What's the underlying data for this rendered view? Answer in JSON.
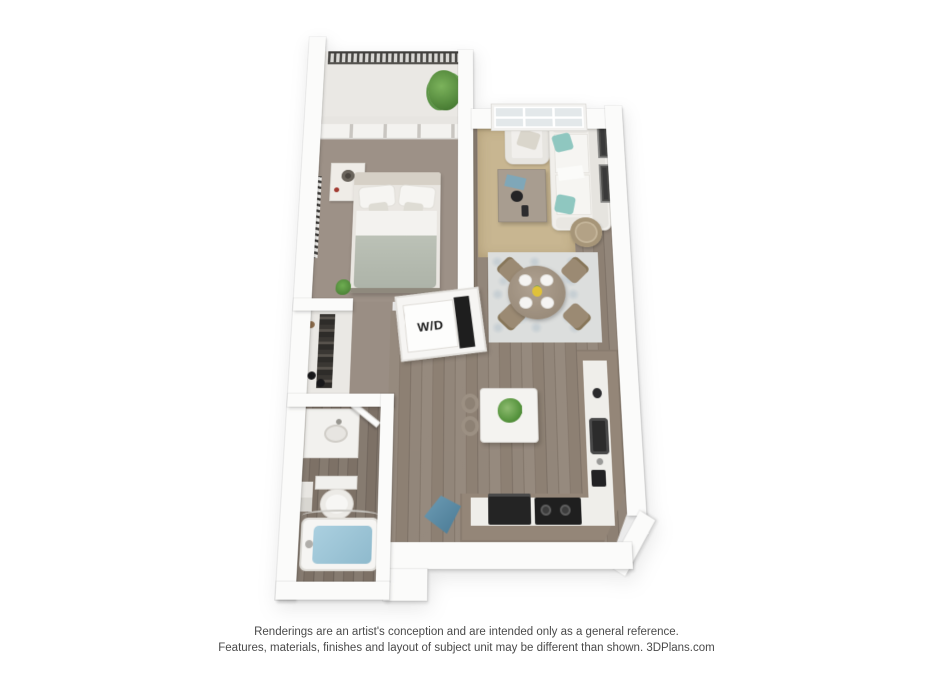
{
  "page": {
    "background": "#ffffff",
    "kind": "3d-floor-plan-rendering"
  },
  "floorplan": {
    "labels": {
      "washer_dryer": "W/D"
    },
    "rooms": [
      "balcony",
      "bedroom",
      "closet",
      "bathroom",
      "hallway",
      "living-room",
      "dining-area",
      "kitchen",
      "laundry-closet"
    ],
    "furniture": {
      "balcony": [
        "railing",
        "potted-plant"
      ],
      "bedroom": [
        "sliding-glass-door",
        "bed",
        "pillows",
        "nightstand",
        "lamp",
        "wall-art",
        "small-plant"
      ],
      "closet": [
        "hanging-clothes-rod",
        "shoes"
      ],
      "bathroom": [
        "vanity-sink",
        "toilet",
        "towels",
        "bathtub",
        "shower-rod"
      ],
      "living_room": [
        "six-pane-window",
        "armchair",
        "coffee-table",
        "sofa",
        "teal-pillows",
        "area-rug",
        "wall-frames",
        "round-basket-table"
      ],
      "dining_area": [
        "round-table",
        "four-chairs",
        "four-plates",
        "yellow-centerpiece",
        "patterned-rug"
      ],
      "kitchen": [
        "l-shaped-counter",
        "sink",
        "range-cooktop",
        "refrigerator",
        "island",
        "island-plant",
        "two-stools",
        "blue-floor-object"
      ]
    },
    "colors": {
      "wall": "#fbfbfa",
      "wood_floor": "#8d8073",
      "bedroom_carpet": "#9d9187",
      "living_rug": "#c8b691",
      "dining_rug": "#dcdedd",
      "kitchen_cabinet": "#948678",
      "countertop": "#efeeea",
      "appliance_black": "#1f1f1f",
      "teal_pillow": "#8fc7c0",
      "tub_water": "#9cc5d8",
      "plant_green": "#54923c",
      "railing_dark": "#4a4946",
      "blanket_sage": "#b9bfb4"
    }
  },
  "footer": {
    "line1": "Renderings are an artist's conception and are intended only as a general reference.",
    "line2": "Features, materials, finishes and layout of subject unit may be different than shown. 3DPlans.com"
  }
}
